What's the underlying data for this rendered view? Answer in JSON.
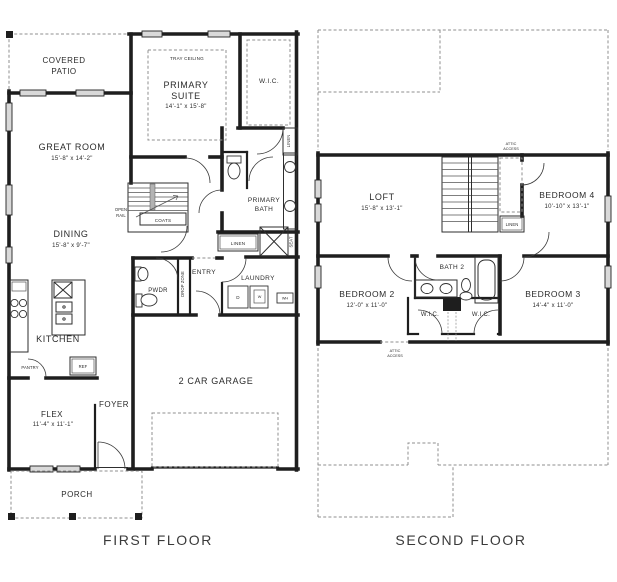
{
  "document": {
    "type": "floor-plan",
    "floors": 2
  },
  "colors": {
    "wall": "#1e1e1e",
    "text": "#2b2b2b",
    "dash": "#8f8f8f",
    "window_fill": "#d9d9d9",
    "background": "#ffffff"
  },
  "first_floor": {
    "caption": "FIRST FLOOR",
    "labels": {
      "covered_patio_line1": "COVERED",
      "covered_patio_line2": "PATIO",
      "tray_ceiling": "TRAY CEILING",
      "primary_suite_line1": "PRIMARY",
      "primary_suite_line2": "SUITE",
      "primary_suite_dims": "14'-1\" x 15'-8\"",
      "wic": "W.I.C.",
      "linen_closet": "LINEN",
      "great_room": "GREAT ROOM",
      "great_room_dims": "15'-8\" x 14'-2\"",
      "open_rail_line1": "OPEN",
      "open_rail_line2": "RAIL",
      "coats": "COATS",
      "primary_bath_line1": "PRIMARY",
      "primary_bath_line2": "BATH",
      "dining": "DINING",
      "dining_dims": "15'-8\" x 9'-7\"",
      "hall_linen": "LINEN",
      "seat": "SEAT",
      "pwdr": "PWDR",
      "drop_zone": "DROP ZONE",
      "entry": "ENTRY",
      "laundry": "LAUNDRY",
      "dryer": "D",
      "washer": "W",
      "water_heater": "WH",
      "kitchen": "KITCHEN",
      "pantry": "PANTRY",
      "refrigerator": "REF",
      "flex": "FLEX",
      "flex_dims": "11'-4\" x 11'-1\"",
      "foyer": "FOYER",
      "garage": "2 CAR GARAGE",
      "porch": "PORCH"
    }
  },
  "second_floor": {
    "caption": "SECOND FLOOR",
    "labels": {
      "attic_access_top_line1": "ATTIC",
      "attic_access_top_line2": "ACCESS",
      "loft": "LOFT",
      "loft_dims": "15'-8\" x 13'-1\"",
      "bedroom4": "BEDROOM 4",
      "bedroom4_dims": "10'-10\" x 13'-1\"",
      "linen": "LINEN",
      "bedroom2": "BEDROOM 2",
      "bedroom2_dims": "12'-0\" x 11'-0\"",
      "bath2": "BATH 2",
      "bedroom3": "BEDROOM 3",
      "bedroom3_dims": "14'-4\" x 11'-0\"",
      "wic_left": "W.I.C.",
      "wic_right": "W.I.C.",
      "attic_access_bottom_line1": "ATTIC",
      "attic_access_bottom_line2": "ACCESS"
    }
  }
}
